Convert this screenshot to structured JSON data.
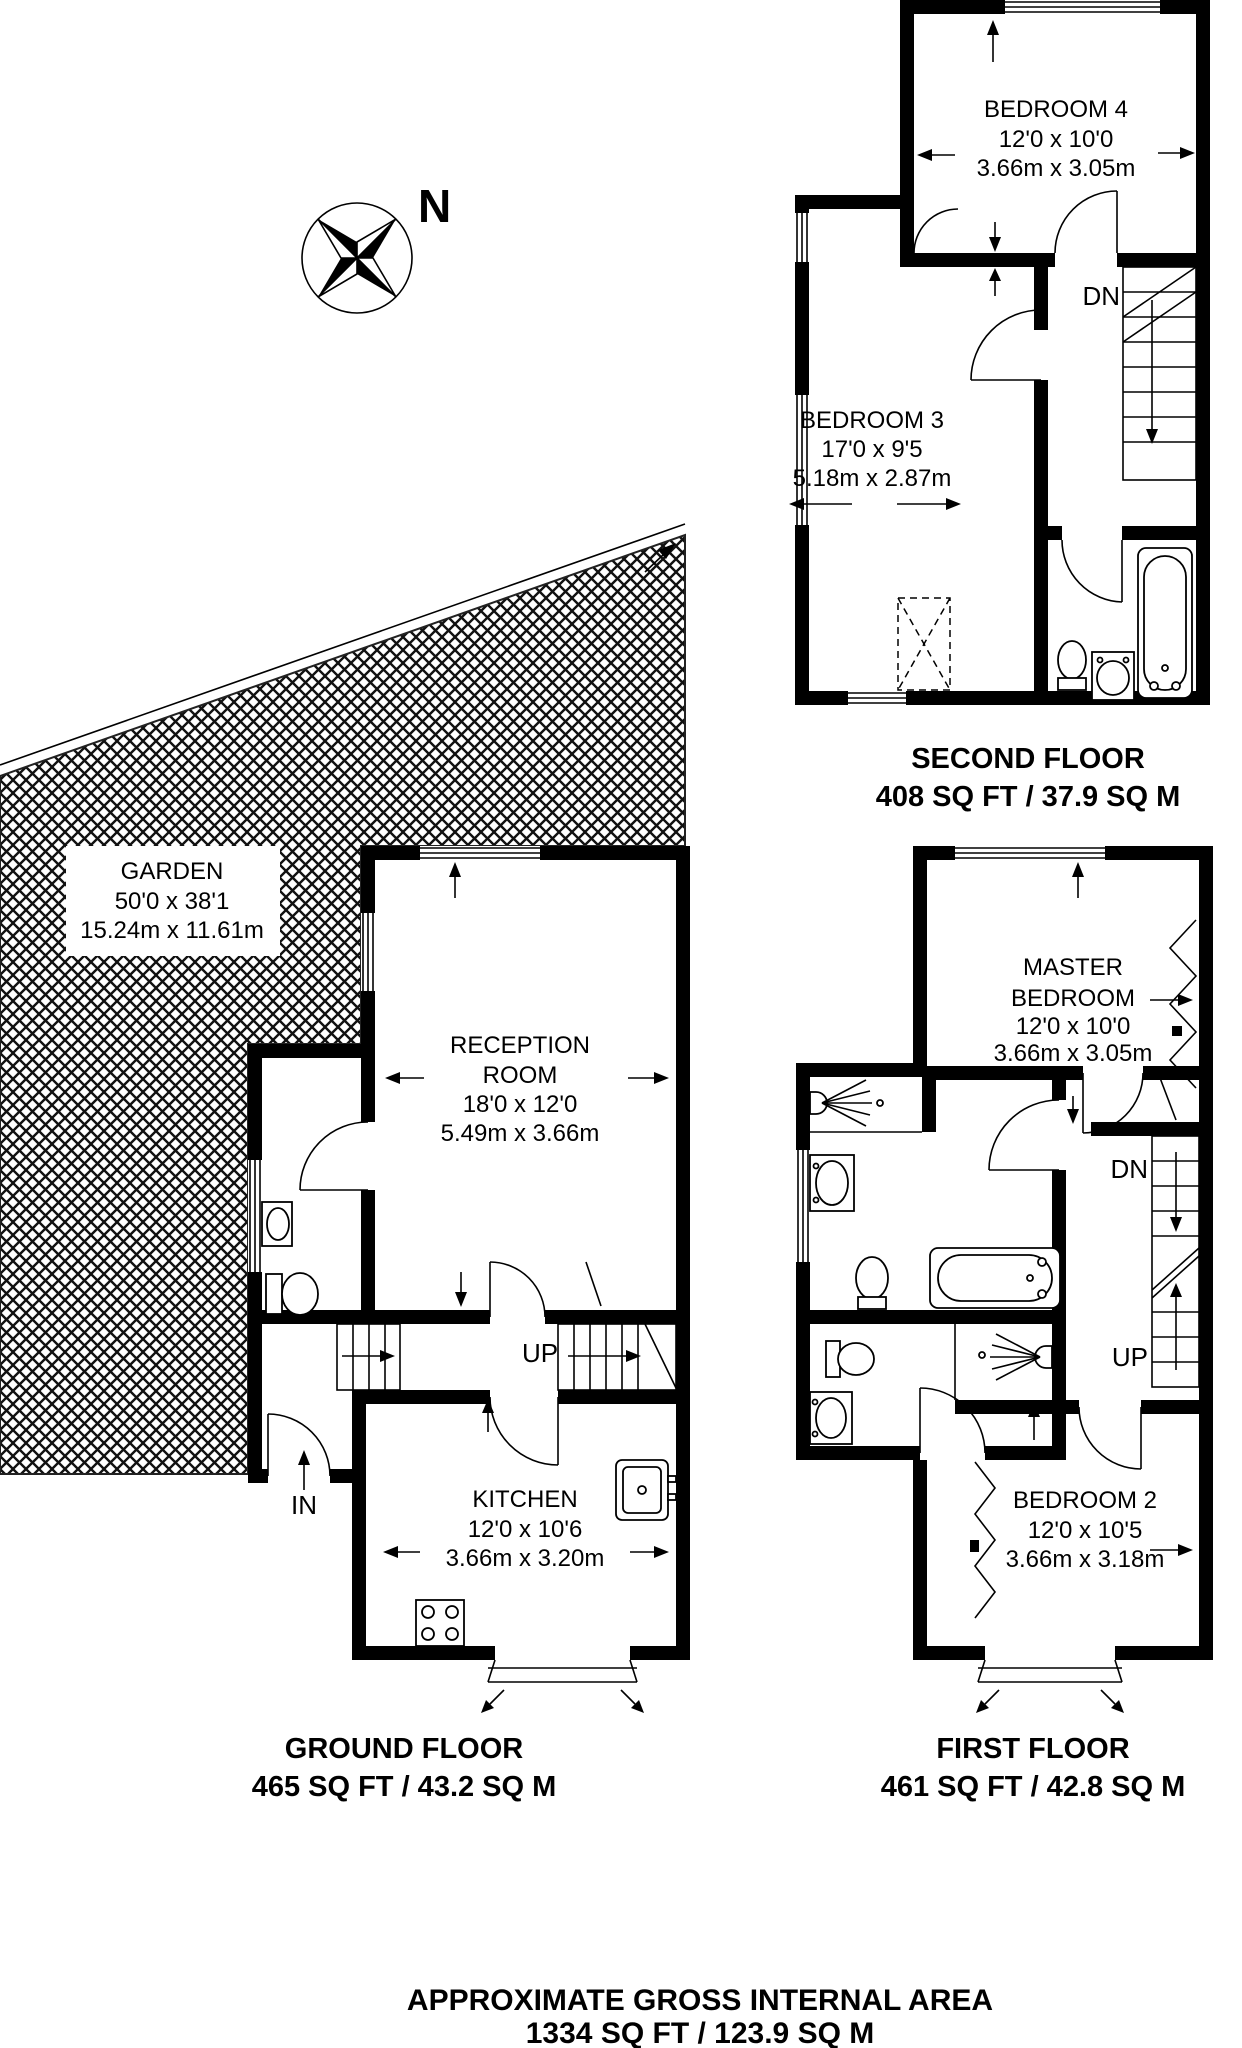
{
  "meta": {
    "colors": {
      "wall": "#000000",
      "background": "#ffffff",
      "text": "#000000",
      "hatch": "#111111"
    }
  },
  "compass": {
    "north_label": "N"
  },
  "garden": {
    "name": "GARDEN",
    "size_imperial": "50'0 x 38'1",
    "size_metric": "15.24m x 11.61m"
  },
  "floors": {
    "second": {
      "title": "SECOND FLOOR",
      "area": "408 SQ FT / 37.9 SQ M",
      "stairs_down": "DN",
      "rooms": {
        "bedroom4": {
          "name": "BEDROOM 4",
          "size_imperial": "12'0 x 10'0",
          "size_metric": "3.66m x 3.05m"
        },
        "bedroom3": {
          "name": "BEDROOM 3",
          "size_imperial": "17'0 x 9'5",
          "size_metric": "5.18m x 2.87m"
        }
      }
    },
    "ground": {
      "title": "GROUND FLOOR",
      "area": "465 SQ FT / 43.2 SQ M",
      "stairs_up": "UP",
      "entrance": "IN",
      "rooms": {
        "reception": {
          "name_line1": "RECEPTION",
          "name_line2": "ROOM",
          "size_imperial": "18'0 x 12'0",
          "size_metric": "5.49m x 3.66m"
        },
        "kitchen": {
          "name": "KITCHEN",
          "size_imperial": "12'0 x 10'6",
          "size_metric": "3.66m x 3.20m"
        }
      }
    },
    "first": {
      "title": "FIRST FLOOR",
      "area": "461 SQ FT / 42.8 SQ M",
      "stairs_down": "DN",
      "stairs_up": "UP",
      "rooms": {
        "master_bedroom": {
          "name_line1": "MASTER",
          "name_line2": "BEDROOM",
          "size_imperial": "12'0 x 10'0",
          "size_metric": "3.66m x 3.05m"
        },
        "bedroom2": {
          "name": "BEDROOM 2",
          "size_imperial": "12'0 x 10'5",
          "size_metric": "3.66m x 3.18m"
        }
      }
    }
  },
  "footer": {
    "title": "APPROXIMATE GROSS INTERNAL AREA",
    "total_area": "1334 SQ FT / 123.9 SQ M"
  }
}
